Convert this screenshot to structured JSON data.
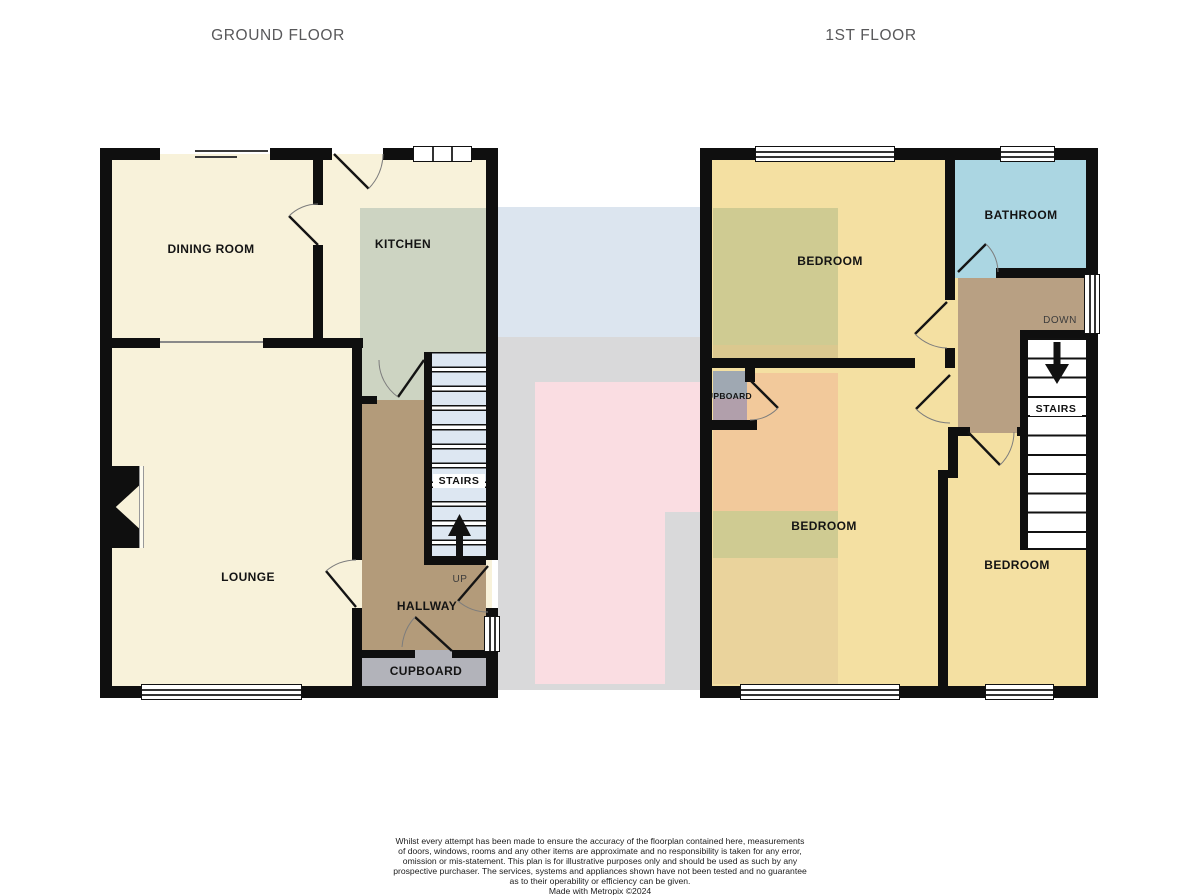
{
  "ground_floor": {
    "title": "GROUND FLOOR",
    "rooms": {
      "dining_room": "DINING ROOM",
      "kitchen": "KITCHEN",
      "lounge": "LOUNGE",
      "stairs": "STAIRS",
      "hallway": "HALLWAY",
      "cupboard": "CUPBOARD",
      "up": "UP"
    }
  },
  "first_floor": {
    "title": "1ST FLOOR",
    "rooms": {
      "bedroom1": "BEDROOM",
      "bathroom": "BATHROOM",
      "bedroom2": "BEDROOM",
      "bedroom3": "BEDROOM",
      "stairs": "STAIRS",
      "cupboard": "CUPBOARD",
      "down": "DOWN"
    }
  },
  "footer": {
    "disclaimer_lines": [
      "Whilst every attempt has been made to ensure the accuracy of the floorplan contained here, measurements",
      "of doors, windows, rooms and any other items are approximate and no responsibility is taken for any error,",
      "omission or mis-statement. This plan is for illustrative purposes only and should be used as such by any",
      "prospective purchaser. The services, systems and appliances shown have not been tested and no guarantee",
      "as to their operability or efficiency can be given."
    ],
    "credit": "Made with Metropix ©2024"
  },
  "colors": {
    "wall": "#0f0f0f",
    "room_cream": "#f8f2da",
    "kitchen_green": "#cdd4c2",
    "hallway_brown": "#b39b7a",
    "landing_brown": "#b8a083",
    "cupboard_gray": "#b2b3ba",
    "stairs_blue": "#dde7f2",
    "bedroom_yellow": "#f4e0a2",
    "olive_overlay": "#cfcb92",
    "orange_overlay": "#f2c99b",
    "tan_overlay": "#ead39c",
    "bed1_tan_strip": "#dbc88f",
    "bathroom_blue": "#abd6e2",
    "cupboard1_gray": "#9fa8b2",
    "cupboard1_mauve": "#b19fab",
    "ghost_blue": "#dce5ef",
    "ghost_gray": "#d9d9da",
    "ghost_pink": "#fadde2",
    "title_gray": "#58585a"
  }
}
